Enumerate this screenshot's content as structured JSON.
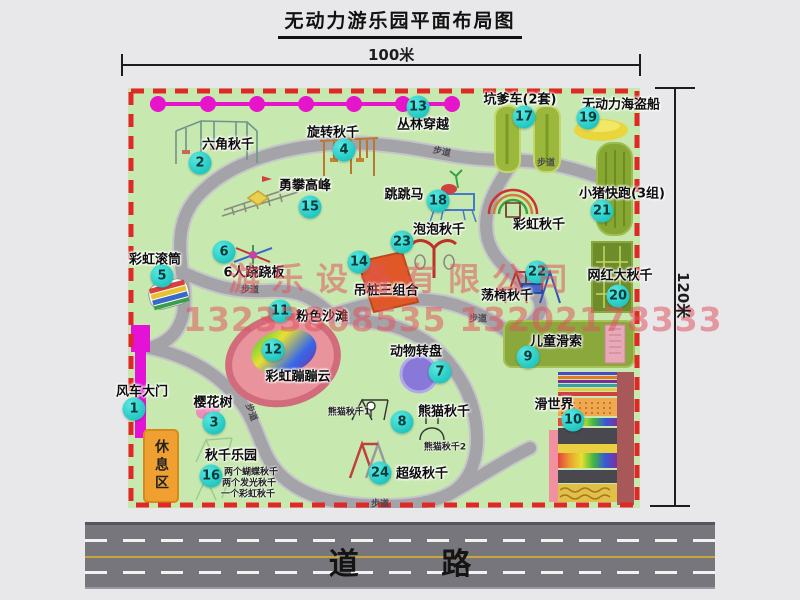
{
  "title": "无动力游乐园平面布局图",
  "dimensions": {
    "width_label": "100米",
    "height_label": "120米"
  },
  "road": {
    "label": "道 路"
  },
  "watermark": {
    "company": "游乐设备有限公司",
    "phones": "13233808535 13202178333"
  },
  "rest_area_label": "休息区",
  "rainbow_swing_label": "彩虹秋千",
  "walkway_label": "步道",
  "attractions": [
    {
      "num": "1",
      "label": "风车大门",
      "lx": 142,
      "ly": 390,
      "bx": 134,
      "by": 409
    },
    {
      "num": "2",
      "label": "六角秋千",
      "lx": 228,
      "ly": 143,
      "bx": 200,
      "by": 163
    },
    {
      "num": "3",
      "label": "樱花树",
      "lx": 213,
      "ly": 401,
      "bx": 214,
      "by": 423
    },
    {
      "num": "4",
      "label": "旋转秋千",
      "lx": 333,
      "ly": 131,
      "bx": 344,
      "by": 150
    },
    {
      "num": "5",
      "label": "彩虹滚筒",
      "lx": 155,
      "ly": 258,
      "bx": 162,
      "by": 276
    },
    {
      "num": "6",
      "label": "6人跷跷板",
      "lx": 254,
      "ly": 271,
      "bx": 224,
      "by": 252
    },
    {
      "num": "7",
      "label": "动物转盘",
      "lx": 416,
      "ly": 350,
      "bx": 440,
      "by": 372
    },
    {
      "num": "8",
      "label": "熊猫秋千",
      "lx": 444,
      "ly": 410,
      "bx": 402,
      "by": 422
    },
    {
      "num": "9",
      "label": "儿童滑索",
      "lx": 556,
      "ly": 340,
      "bx": 528,
      "by": 357
    },
    {
      "num": "10",
      "label": "滑世界",
      "lx": 554,
      "ly": 403,
      "bx": 573,
      "by": 420
    },
    {
      "num": "11",
      "label": "粉色沙滩",
      "lx": 322,
      "ly": 315,
      "bx": 280,
      "by": 311
    },
    {
      "num": "12",
      "label": "彩虹蹦蹦云",
      "lx": 298,
      "ly": 375,
      "bx": 273,
      "by": 350
    },
    {
      "num": "13",
      "label": "丛林穿越",
      "lx": 423,
      "ly": 123,
      "bx": 418,
      "by": 107
    },
    {
      "num": "14",
      "label": "吊桩三组合",
      "lx": 386,
      "ly": 289,
      "bx": 359,
      "by": 262
    },
    {
      "num": "15",
      "label": "勇攀高峰",
      "lx": 305,
      "ly": 184,
      "bx": 310,
      "by": 207
    },
    {
      "num": "16",
      "label": "秋千乐园",
      "lx": 231,
      "ly": 454,
      "bx": 211,
      "by": 476
    },
    {
      "num": "17",
      "label": "坑爹车(2套)",
      "lx": 520,
      "ly": 98,
      "bx": 524,
      "by": 117
    },
    {
      "num": "18",
      "label": "跳跳马",
      "lx": 404,
      "ly": 193,
      "bx": 438,
      "by": 201
    },
    {
      "num": "19",
      "label": "无动力海盗船",
      "lx": 621,
      "ly": 103,
      "bx": 588,
      "by": 118
    },
    {
      "num": "20",
      "label": "网红大秋千",
      "lx": 620,
      "ly": 274,
      "bx": 618,
      "by": 296
    },
    {
      "num": "21",
      "label": "小猪快跑(3组)",
      "lx": 622,
      "ly": 192,
      "bx": 602,
      "by": 211
    },
    {
      "num": "22",
      "label": "荡椅秋千",
      "lx": 507,
      "ly": 294,
      "bx": 537,
      "by": 272
    },
    {
      "num": "23",
      "label": "泡泡秋千",
      "lx": 439,
      "ly": 228,
      "bx": 402,
      "by": 242
    },
    {
      "num": "24",
      "label": "超级秋千",
      "lx": 422,
      "ly": 472,
      "bx": 380,
      "by": 473
    }
  ],
  "sub_labels": [
    {
      "text": "熊猫秋千1",
      "x": 349,
      "y": 411
    },
    {
      "text": "熊猫秋千2",
      "x": 445,
      "y": 446
    },
    {
      "text": "两个蝴蝶秋千",
      "x": 251,
      "y": 471
    },
    {
      "text": "两个发光秋千",
      "x": 249,
      "y": 482
    },
    {
      "text": "一个彩虹秋千",
      "x": 248,
      "y": 493
    }
  ],
  "walkways": [
    {
      "x": 442,
      "y": 151,
      "rot": 12
    },
    {
      "x": 546,
      "y": 162,
      "rot": 0
    },
    {
      "x": 250,
      "y": 289,
      "rot": 0
    },
    {
      "x": 478,
      "y": 318,
      "rot": 0
    },
    {
      "x": 252,
      "y": 412,
      "rot": 70
    },
    {
      "x": 380,
      "y": 503,
      "rot": 0
    }
  ],
  "colors": {
    "map_bg": "#c7e8af",
    "border_dash": "#e02828",
    "badge": "#22c7c2",
    "cable": "#e615cb",
    "gate": "#e411d6",
    "road": "#76767c",
    "watermark": "#de555f"
  }
}
